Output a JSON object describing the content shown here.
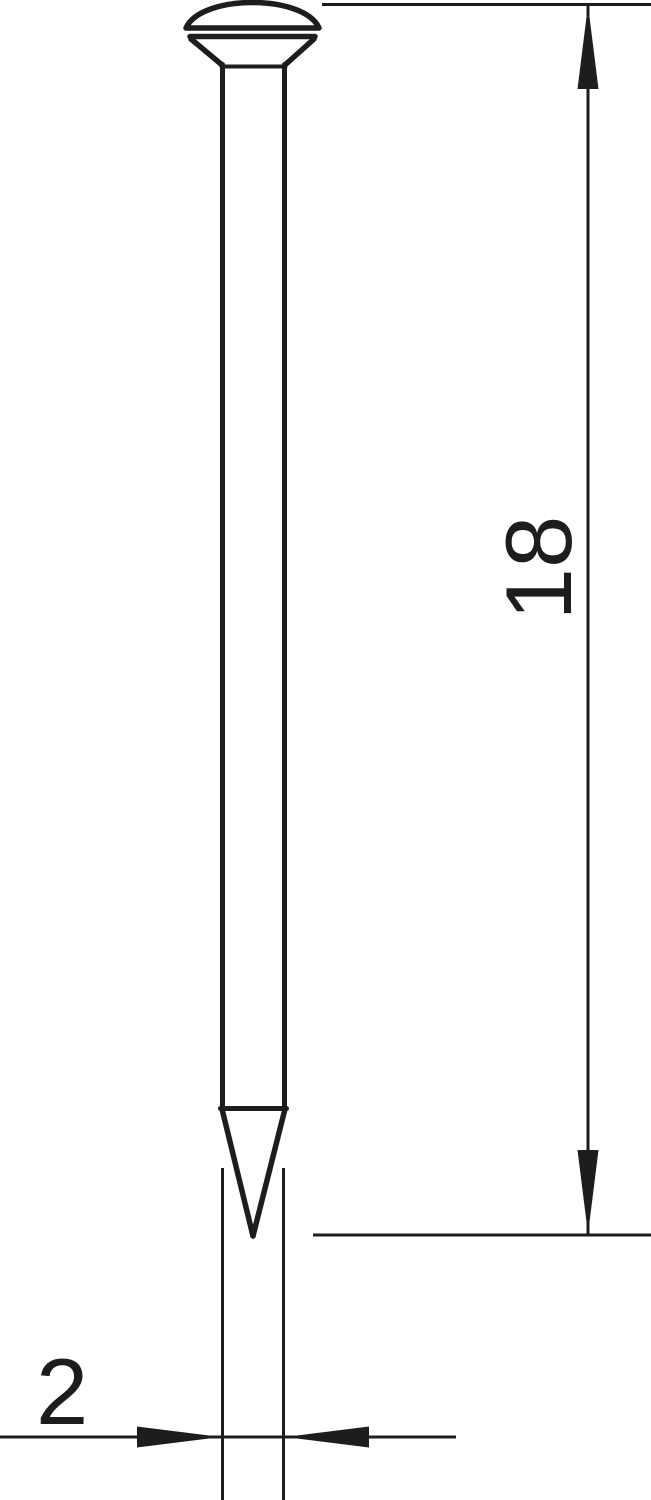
{
  "drawing": {
    "background_color": "#ffffff",
    "line_color": "#1d1d1b",
    "dimension_labels": {
      "length": "18",
      "diameter": "2"
    }
  }
}
